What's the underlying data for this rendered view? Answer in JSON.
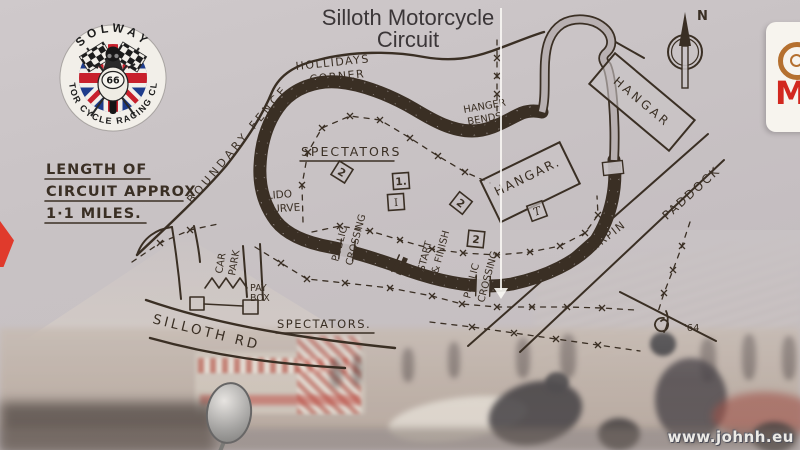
{
  "title": {
    "line1": "Silloth Motorcycle",
    "line2": "Circuit"
  },
  "club_badge": {
    "arc_top": "SOLWAY",
    "arc_bottom": "MOTOR CYCLE RACING CLUB",
    "plate_number": "66"
  },
  "length_note": {
    "line1": "LENGTH OF",
    "line2": "CIRCUIT APPROX",
    "line3": "1·1 MILES."
  },
  "compass": {
    "north": "N"
  },
  "map": {
    "labels": {
      "hollidays_line1": "HOLLIDAYS",
      "hollidays_line2": "CORNER",
      "boundary_fence": "BOUNDARY FENCE",
      "spectators_infield": "SPECTATORS",
      "lido_line1": "LIDO",
      "lido_line2": "CURVE",
      "crossing_left_line1": "PUBLIC",
      "crossing_left_line2": "CROSSING",
      "crossing_right_line1": "PUBLIC",
      "crossing_right_line2": "CROSSING",
      "start_finish_line1": "START",
      "start_finish_line2": "& FINISH",
      "hanger_bends_line1": "HANGER",
      "hanger_bends_line2": "BENDS",
      "hangar_north": "HANGAR",
      "hangar_main": "HANGAR.",
      "hairpin": "HAIRPIN",
      "paddock": "PADDOCK",
      "car_park_line1": "CAR",
      "car_park_line2": "PARK",
      "pay_box_line1": "PAY",
      "pay_box_line2": "BOX",
      "silloth_road": "SILLOTH RD",
      "spectators_road": "SPECTATORS.",
      "year_mark": "'64"
    },
    "markers": {
      "post_nw": "2",
      "post_one": "1.",
      "post_i": "I",
      "post_mid": "2",
      "post_start": "2",
      "hangar_t": "T"
    }
  },
  "sponsor_card": {
    "letter": "M"
  },
  "watermark": {
    "text": "www.johnh.eu"
  },
  "colors": {
    "board": "#c8c2c4",
    "ink": "#3a2f24",
    "badge_blue": "#1e3c8c",
    "badge_red": "#c8202c",
    "sponsor_red": "#d2281f",
    "red_object": "#e03a2c"
  }
}
